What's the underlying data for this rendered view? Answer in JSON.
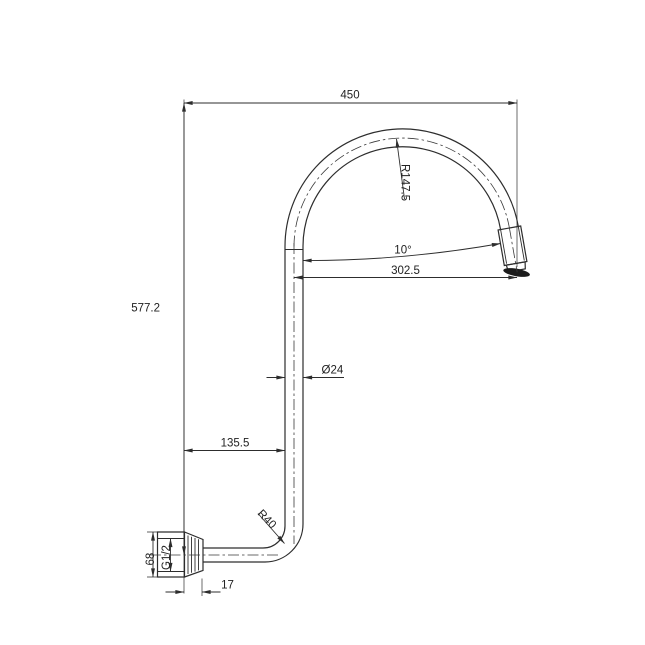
{
  "drawing": {
    "background": "#ffffff",
    "line_color": "#2d2d2d",
    "dimensions": {
      "overall_width": "450",
      "overall_height": "577.2",
      "arc_radius": "R147.5",
      "spout_angle": "10°",
      "horizontal_reach": "302.5",
      "pipe_diameter": "Ø24",
      "wall_to_pipe": "135.5",
      "elbow_radius": "R40",
      "flange_size": "68",
      "thread_size": "G1/2",
      "flange_depth": "17"
    }
  }
}
